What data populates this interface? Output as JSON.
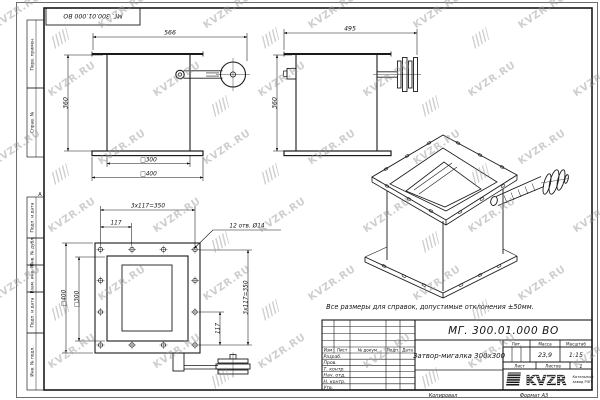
{
  "watermark": {
    "text": "KVZR.RU"
  },
  "frame": {
    "left_labels": [
      "Перв. примен.",
      "Справ. №",
      "Подп. и дата",
      "Инв. № дубл.",
      "Взам. инв. №",
      "Подп. и дата",
      "Инв. № подл."
    ],
    "zone_label": "А",
    "top_stamp": "МГ. 300.01.000 ВО"
  },
  "drawing": {
    "note": "Все размеры для справок, допустимые отклонения ±50мм.",
    "front_view": {
      "width": "566",
      "height": "360",
      "inner_square": "□300",
      "outer_square": "□400"
    },
    "side_view": {
      "width": "495",
      "height": "360"
    },
    "plan_view": {
      "pitch_h": "3x117=350",
      "step_h": "117",
      "holes_note": "12 отв. Ø14",
      "outer_square": "□400",
      "inner_square": "□300",
      "pitch_v": "3x117=350",
      "step_v": "117"
    }
  },
  "title_block": {
    "designation": "МГ. 300.01.000 ВО",
    "part_name": "Затвор-мигалка 300х300",
    "header_cols": [
      "Изм",
      "Лист",
      "№ докум.",
      "Подп.",
      "Дата"
    ],
    "sign_rows": [
      "Разраб.",
      "Пров.",
      "Т. контр.",
      "Нач. отд.",
      "Н. контр.",
      "Утв."
    ],
    "lit_label": "Лит.",
    "mass_label": "Масса",
    "mass_value": "23,9",
    "scale_label": "Масштаб",
    "scale_value": "1:15",
    "sheet_label": "Лист",
    "sheets_label": "Листов",
    "sheets_value": "1",
    "company": {
      "logo_text": "KVZR",
      "name_line1": "Котельный",
      "name_line2": "завод РЭП"
    },
    "footer": {
      "copied_label": "Копировал",
      "format_label": "Формат А3"
    }
  }
}
